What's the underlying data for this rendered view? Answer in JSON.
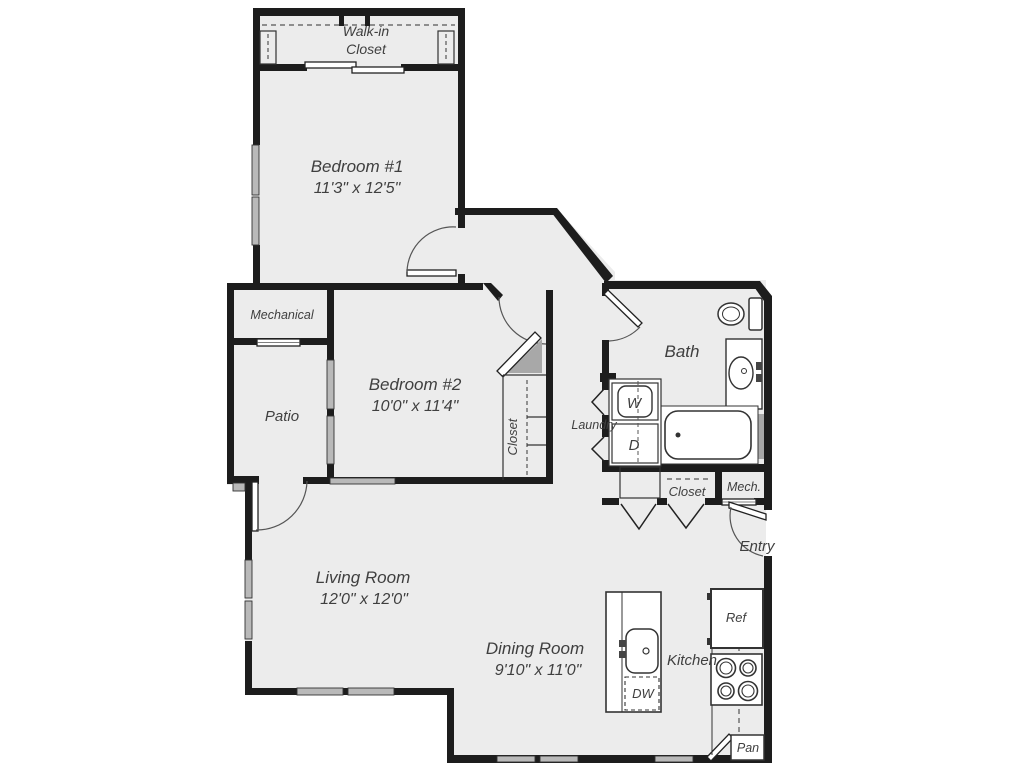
{
  "floorplan": {
    "colors": {
      "background": "#ffffff",
      "floor": "#ececec",
      "wall": "#1d1d1d",
      "label": "#3f3f3f",
      "shade": "#a8a8a8"
    },
    "rooms": {
      "walk_in_closet": {
        "line1": "Walk-in",
        "line2": "Closet"
      },
      "bedroom1": {
        "name": "Bedroom #1",
        "dims": "11'3\" x 12'5\""
      },
      "mechanical": {
        "name": "Mechanical"
      },
      "patio": {
        "name": "Patio"
      },
      "bedroom2": {
        "name": "Bedroom #2",
        "dims": "10'0\" x 11'4\""
      },
      "bedroom2_closet": {
        "name": "Closet"
      },
      "laundry": {
        "name": "Laundry",
        "washer_label": "W",
        "dryer_label": "D"
      },
      "bath": {
        "name": "Bath"
      },
      "hall_closet": {
        "name": "Closet"
      },
      "mech_closet": {
        "name": "Mech."
      },
      "entry": {
        "name": "Entry"
      },
      "living_room": {
        "name": "Living Room",
        "dims": "12'0\" x 12'0\""
      },
      "dining_room": {
        "name": "Dining Room",
        "dims": "9'10\" x 11'0\""
      },
      "kitchen": {
        "name": "Kitchen",
        "refrigerator_label": "Ref",
        "dishwasher_label": "DW",
        "pantry_label": "Pan"
      }
    }
  }
}
